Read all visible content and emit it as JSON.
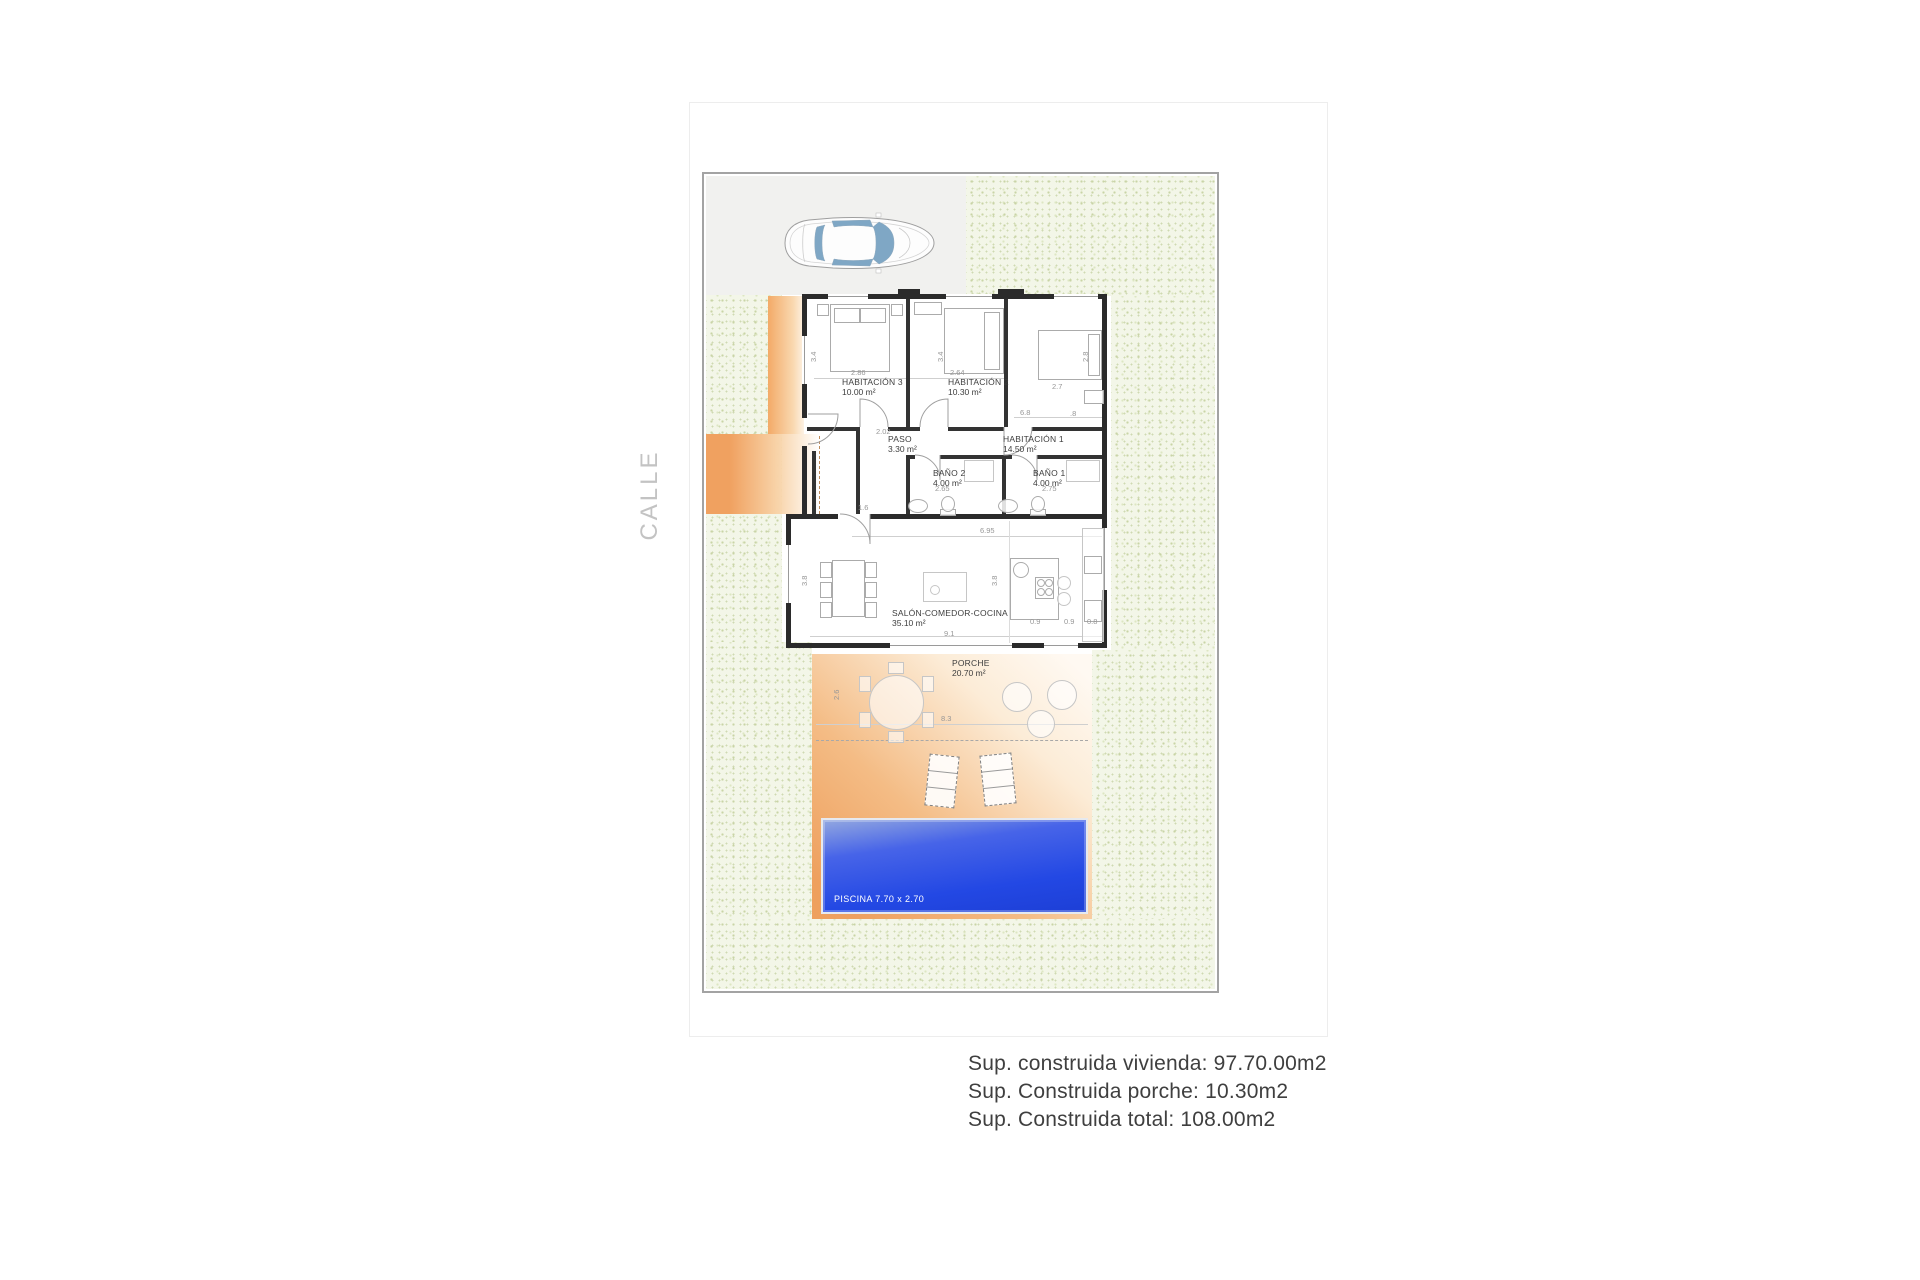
{
  "street_label": "CALLE",
  "plan": {
    "rooms": [
      {
        "name": "HABITACIÓN 3",
        "area": "10.00 m²",
        "x": 842,
        "y": 377
      },
      {
        "name": "HABITACIÓN 2",
        "area": "10.30 m²",
        "x": 948,
        "y": 377
      },
      {
        "name": "HABITACIÓN 1",
        "area": "14.50 m²",
        "x": 1003,
        "y": 434
      },
      {
        "name": "PASO",
        "area": "3.30 m²",
        "x": 888,
        "y": 434
      },
      {
        "name": "BAÑO 2",
        "area": "4.00 m²",
        "x": 933,
        "y": 468
      },
      {
        "name": "BAÑO 1",
        "area": "4.00 m²",
        "x": 1033,
        "y": 468
      },
      {
        "name": "SALÓN-COMEDOR-COCINA",
        "area": "35.10 m²",
        "x": 892,
        "y": 608
      },
      {
        "name": "PORCHE",
        "area": "20.70 m²",
        "x": 952,
        "y": 658
      }
    ],
    "pool_label": "PISCINA 7.70 x 2.70",
    "dims": [
      {
        "t": "2.86",
        "x": 851,
        "y": 368,
        "r": 0
      },
      {
        "t": "3.4",
        "x": 809,
        "y": 362,
        "r": 1
      },
      {
        "t": "2.64",
        "x": 950,
        "y": 368,
        "r": 0
      },
      {
        "t": "3.4",
        "x": 936,
        "y": 362,
        "r": 1
      },
      {
        "t": "2.8",
        "x": 1081,
        "y": 362,
        "r": 1
      },
      {
        "t": "2.7",
        "x": 1052,
        "y": 382,
        "r": 0
      },
      {
        "t": "6.8",
        "x": 1020,
        "y": 408,
        "r": 0
      },
      {
        "t": ".8",
        "x": 1070,
        "y": 409,
        "r": 0
      },
      {
        "t": "2.02",
        "x": 876,
        "y": 427,
        "r": 0
      },
      {
        "t": "1.6",
        "x": 858,
        "y": 503,
        "r": 0
      },
      {
        "t": "2.65",
        "x": 935,
        "y": 484,
        "r": 0
      },
      {
        "t": "2.75",
        "x": 1042,
        "y": 484,
        "r": 0
      },
      {
        "t": "6.95",
        "x": 980,
        "y": 526,
        "r": 0
      },
      {
        "t": "3.8",
        "x": 800,
        "y": 586,
        "r": 1
      },
      {
        "t": "3.8",
        "x": 990,
        "y": 586,
        "r": 1
      },
      {
        "t": "9.1",
        "x": 944,
        "y": 629,
        "r": 0
      },
      {
        "t": "0.9",
        "x": 1030,
        "y": 617,
        "r": 0
      },
      {
        "t": "0.9",
        "x": 1064,
        "y": 617,
        "r": 0
      },
      {
        "t": "0.8",
        "x": 1087,
        "y": 617,
        "r": 0
      },
      {
        "t": "8.3",
        "x": 941,
        "y": 714,
        "r": 0
      },
      {
        "t": "2.6",
        "x": 832,
        "y": 700,
        "r": 1
      }
    ]
  },
  "summary": {
    "lines": [
      "Sup. construida vivienda: 97.70.00m2",
      "Sup. Construida porche: 10.30m2",
      "Sup. Construida total: 108.00m2"
    ]
  },
  "colors": {
    "deck_orange": "#efa05e",
    "pool_blue": "#2348e4",
    "garden_green": "#f3f6e8",
    "wall": "#2b2b2b"
  }
}
